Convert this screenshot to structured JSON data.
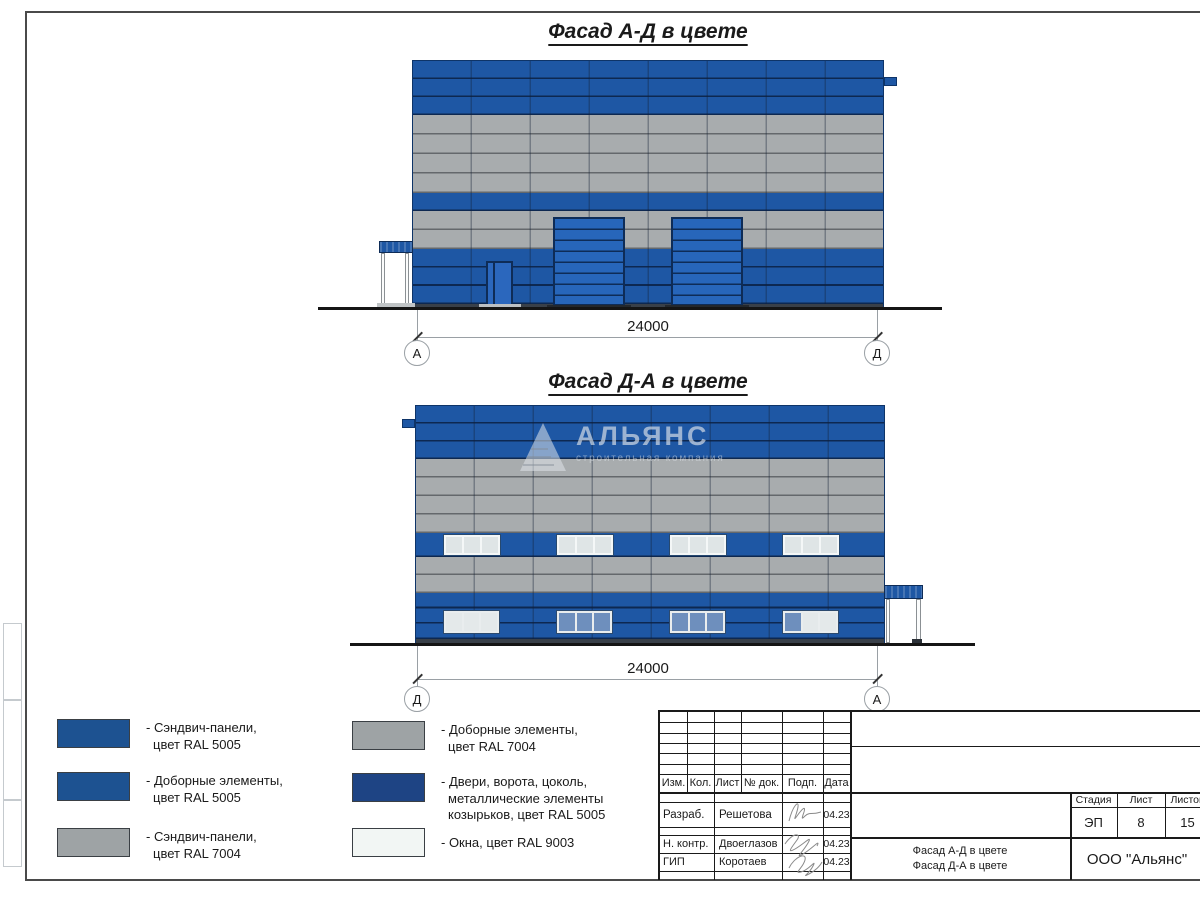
{
  "titles": {
    "facade_ad": "Фасад А-Д в цвете",
    "facade_da": "Фасад Д-А в цвете"
  },
  "dimensions": {
    "facade_ad": {
      "length": "24000",
      "axis_left": "А",
      "axis_right": "Д"
    },
    "facade_da": {
      "length": "24000",
      "axis_left": "Д",
      "axis_right": "А"
    }
  },
  "watermark": {
    "title": "АЛЬЯНС",
    "subtitle": "строительная компания"
  },
  "legend": {
    "items": [
      {
        "color": "#1d5291",
        "lines": [
          "- Сэндвич-панели,",
          "цвет RAL 5005"
        ]
      },
      {
        "color": "#1d5291",
        "lines": [
          "- Доборные элементы,",
          "цвет RAL 5005"
        ]
      },
      {
        "color": "#9ea3a5",
        "lines": [
          "- Сэндвич-панели,",
          "цвет RAL 7004"
        ]
      },
      {
        "color": "#9ea3a5",
        "lines": [
          "- Доборные элементы,",
          "цвет RAL 7004"
        ]
      },
      {
        "color": "#1e4484",
        "lines": [
          "- Двери, ворота, цоколь,",
          "металлические элементы",
          "козырьков, цвет RAL 5005"
        ]
      },
      {
        "color": "#f2f6f4",
        "lines": [
          "- Окна, цвет RAL 9003"
        ]
      }
    ]
  },
  "title_block": {
    "cols": [
      "Изм.",
      "Кол.",
      "Лист",
      "№ док.",
      "Подп.",
      "Дата"
    ],
    "rows": [
      {
        "role": "Разраб.",
        "name": "Решетова",
        "date": "04.23"
      },
      {
        "role": "Н. контр.",
        "name": "Двоеглазов",
        "date": "04.23"
      },
      {
        "role": "ГИП",
        "name": "Коротаев",
        "date": "04.23"
      }
    ],
    "stage_label": "Стадия",
    "sheet_label": "Лист",
    "sheets_label": "Листов",
    "stage": "ЭП",
    "sheet_no": "8",
    "sheets_total": "15",
    "doc_title_line1": "Фасад А-Д в цвете",
    "doc_title_line2": "Фасад Д-А в цвете",
    "company": "ООО \"Альянс\""
  },
  "colors": {
    "ral5005": "#1d5291",
    "ral5005_dark": "#1e4484",
    "ral7004": "#9ea3a5",
    "ral9003": "#f2f6f4",
    "panel_blue": "#1e57a4",
    "panel_gray": "#a8acae"
  }
}
